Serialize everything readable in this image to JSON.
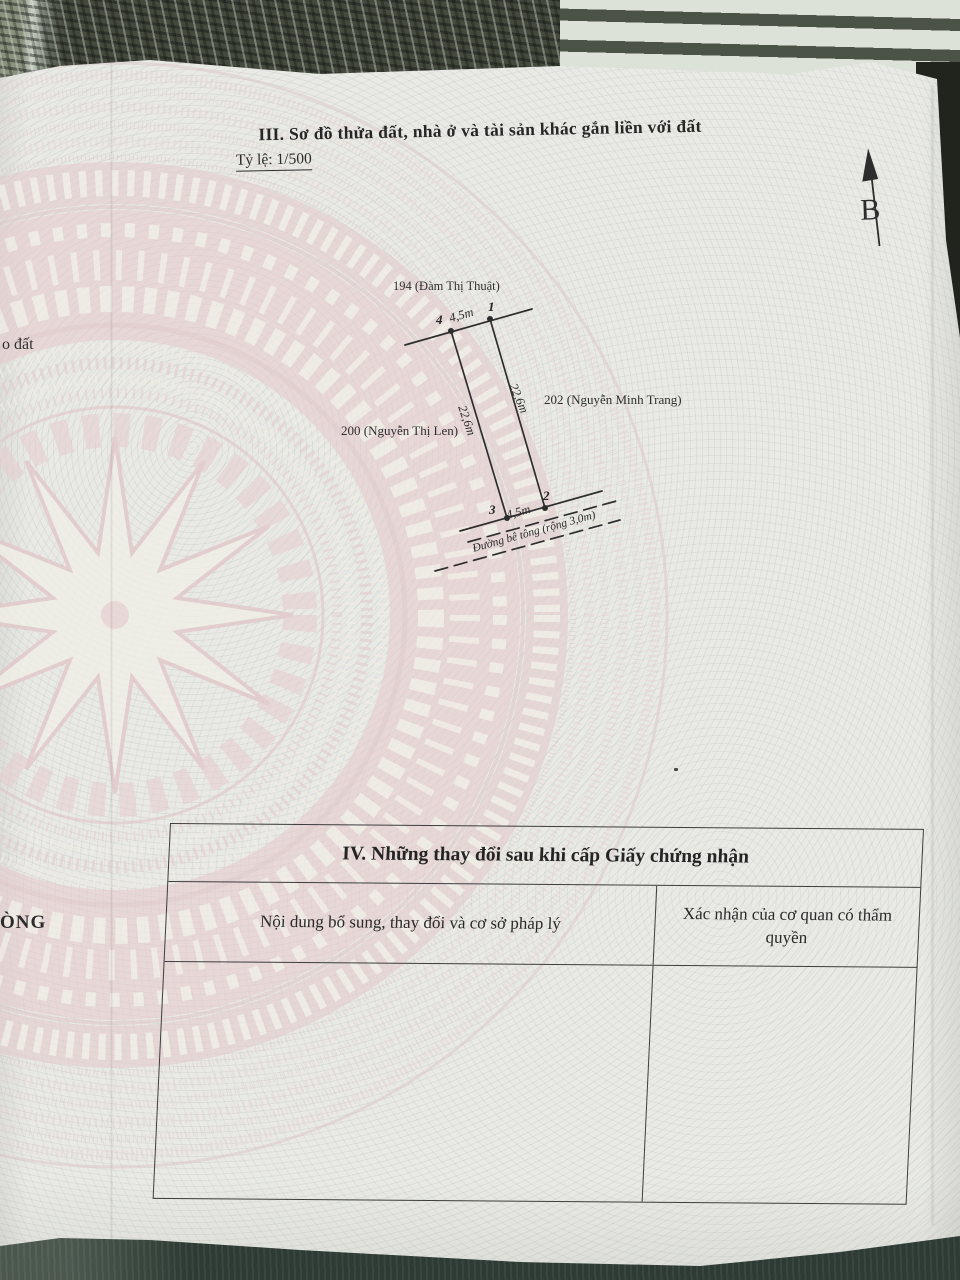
{
  "document": {
    "section_iii": {
      "heading": "III. Sơ đồ thửa đất, nhà ở và tài sản khác gắn liền với đất",
      "scale_note": "Tỷ lệ: 1/500"
    },
    "compass": {
      "north_label": "B"
    },
    "parcel_diagram": {
      "neighbor_top": "194 (Đàm Thị Thuật)",
      "neighbor_left": "200 (Nguyễn Thị Len)",
      "neighbor_right": "202 (Nguyễn Minh Trang)",
      "road_label": "Đường bê tông (rộng 3,0m)",
      "corners": {
        "c1": "1",
        "c2": "2",
        "c3": "3",
        "c4": "4"
      },
      "dimensions": {
        "top": "4,5m",
        "bottom": "4,5m",
        "left": "22,6m",
        "right": "22,6m"
      }
    },
    "edge_text_fragments": {
      "middle_left": "o đất",
      "lower_left": "ÒNG"
    },
    "section_iv": {
      "heading": "IV. Những thay đổi sau khi cấp Giấy chứng nhận",
      "column_left_header": "Nội dung bổ sung, thay đổi và cơ sở pháp lý",
      "column_right_header": "Xác nhận của cơ quan có thẩm quyền",
      "body_left": "",
      "body_right": ""
    },
    "palette": {
      "paper": "#e9eae5",
      "drum_pink": "#e6cdcf",
      "ink": "#2b2b2b",
      "fabric_dark": "#454a3f",
      "fabric_stripe_light": "#dce2d7",
      "fabric_bottom": "#2d3b34"
    }
  }
}
